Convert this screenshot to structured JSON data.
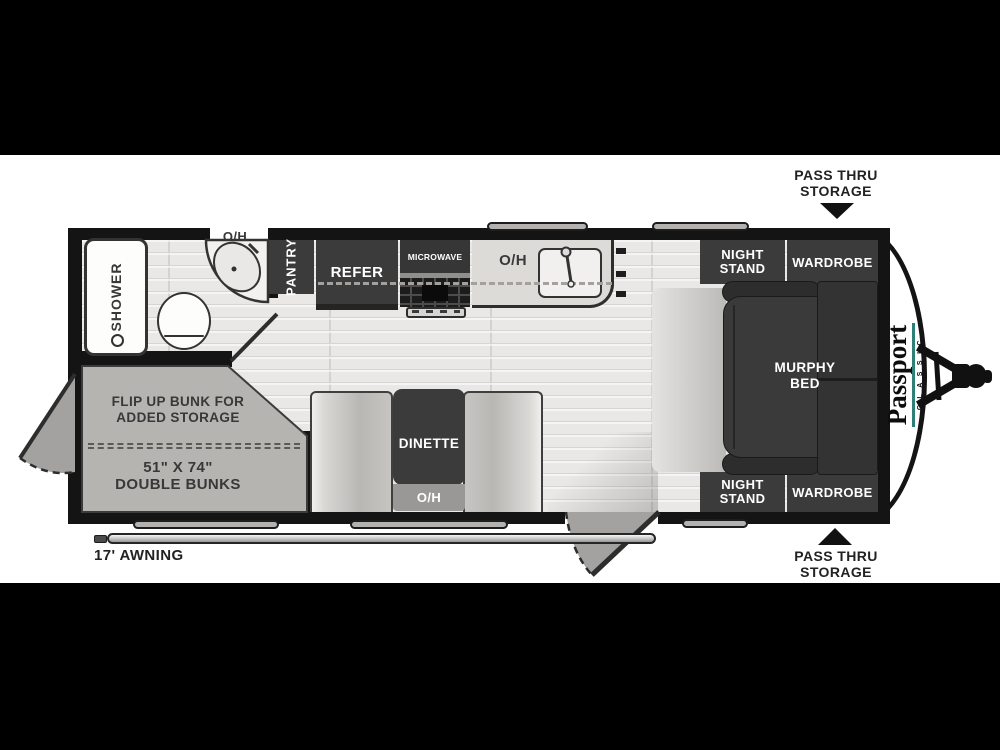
{
  "exterior": {
    "pass_thru_top": {
      "line1": "PASS THRU",
      "line2": "STORAGE"
    },
    "pass_thru_bottom": {
      "line1": "PASS THRU",
      "line2": "STORAGE"
    },
    "awning_label": "17' AWNING"
  },
  "logo": {
    "brand": "Passport",
    "series": "CLASSIC"
  },
  "bathroom": {
    "shower": "SHOWER",
    "overhead": "O/H"
  },
  "kitchen": {
    "pantry": "PANTRY",
    "refrigerator": "REFER",
    "microwave": "MICROWAVE",
    "overhead": "O/H"
  },
  "bedroom": {
    "night_stand_top": {
      "line1": "NIGHT",
      "line2": "STAND"
    },
    "wardrobe_top": "WARDROBE",
    "murphy_bed": {
      "line1": "MURPHY",
      "line2": "BED"
    },
    "night_stand_bottom": {
      "line1": "NIGHT",
      "line2": "STAND"
    },
    "wardrobe_bottom": "WARDROBE"
  },
  "dinette": {
    "table": "DINETTE",
    "overhead": "O/H"
  },
  "bunks": {
    "note_line1": "FLIP UP BUNK FOR",
    "note_line2": "ADDED STORAGE",
    "size": "51\" X 74\"",
    "type": "DOUBLE BUNKS"
  },
  "colors": {
    "wall": "#141414",
    "furniture_dark": "#3c3b3b",
    "floor": "#e9e8e6",
    "bunk_gray": "#b6b4b0",
    "door_swing_gray": "#a3a2a0",
    "logo_accent_teal": "#2e7f78"
  }
}
